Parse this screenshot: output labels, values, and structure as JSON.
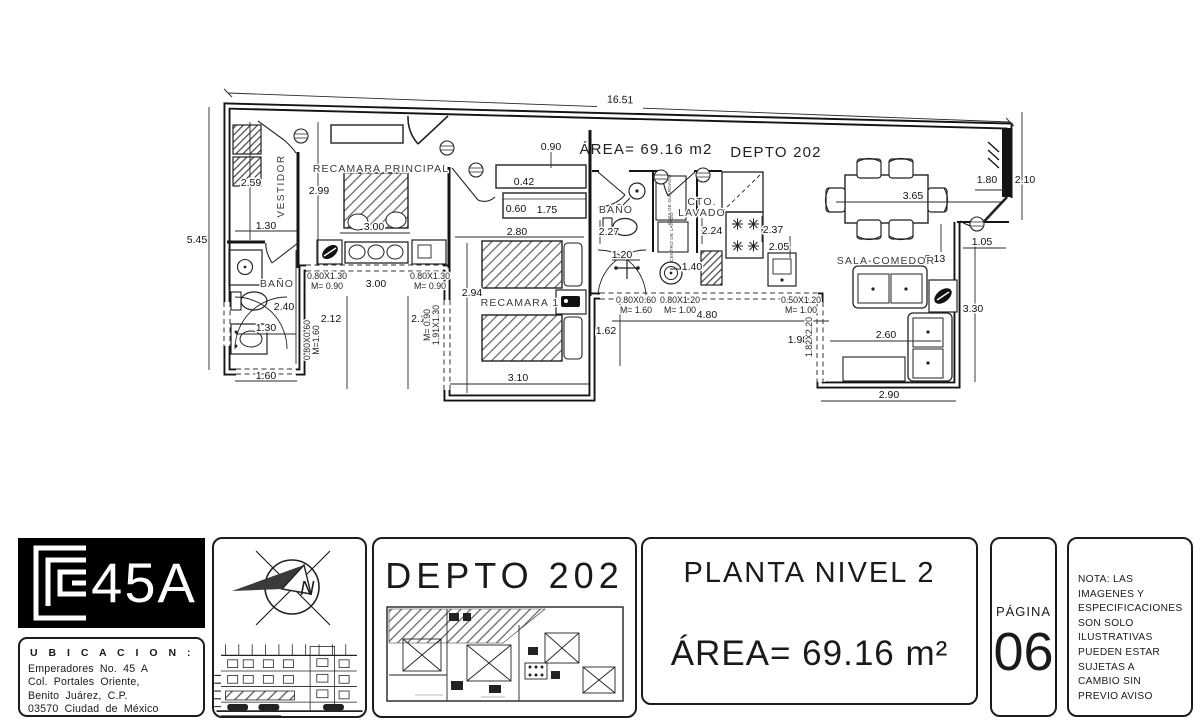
{
  "plan": {
    "area_text": "ÁREA= 69.16 m2",
    "unit_text": "DEPTO 202",
    "rooms": {
      "vestidor": "VESTIDOR",
      "recamara_principal": "RECAMARA PRINCIPAL",
      "banio_1": "BAÑO",
      "recamara_1": "RECAMARA 1",
      "banio_2": "BAÑO",
      "cto_lavado_l1": "CTO.",
      "cto_lavado_l2": "LAVADO",
      "area_guardado": "ÁREA DE GUARDADO",
      "centro_lavado": "CENTRO DE LAVADO",
      "sala_comedor": "SALA-COMEDOR"
    },
    "dims": {
      "d1651": "16.51",
      "d545": "5.45",
      "d259": "2.59",
      "d299": "2.99",
      "d130a": "1.30",
      "d300a": "3.00",
      "d300b": "3.00",
      "d090": "0.90",
      "d042": "0.42",
      "d060": "0.60",
      "d175": "1.75",
      "d280": "2.80",
      "d227": "2.27",
      "d120": "1.20",
      "d224": "2.24",
      "d237": "2.37",
      "d205": "2.05",
      "d365": "3.65",
      "d180": "1.80",
      "d210": "2.10",
      "d105": "1.05",
      "d513": "5.13",
      "d330": "3.30",
      "d240": "2.40",
      "d130b": "1.30",
      "d160": "1.60",
      "d212": "2.12",
      "d211": "2.11",
      "d294": "2.94",
      "d310": "3.10",
      "d162": "1.62",
      "d480": "4.80",
      "d140": "1.40",
      "d198": "1.98",
      "d260": "2.60",
      "d290": "2.90"
    },
    "openings": {
      "w1_l1": "0.80X1.30",
      "w1_l2": "M= 0.90",
      "w2_l1": "0.80X1.30",
      "w2_l2": "M= 0.90",
      "w3_l1": "0.80X0.60",
      "w3_l2": "M= 1.60",
      "w4_l1": "0.80X1.20",
      "w4_l2": "M= 1.00",
      "w5_l1": "0.50X1.20",
      "w5_l2": "M= 1.00",
      "w6_l1": "0.80X0.60",
      "w6_l2": "M=1.60",
      "w7_l1": "M= 0.90",
      "w7_l2": "1.91X1.30",
      "w8": "1.82X2.20"
    }
  },
  "titleblock": {
    "logo_text": "45A",
    "ubicacion_title": "U B I C A C I O N :",
    "ubicacion_lines": [
      "Emperadores No. 45 A",
      "Col. Portales Oriente,",
      "Benito Juárez, C.P.",
      "03570 Ciudad de México"
    ],
    "compass_n": "N",
    "depto_title": "DEPTO 202",
    "planta_title": "PLANTA NIVEL 2",
    "area_title": "ÁREA= 69.16 m²",
    "pagina_label": "PÁGINA",
    "pagina_number": "06",
    "nota_lines": [
      "NOTA: LAS",
      "IMAGENES Y",
      "ESPECIFICACIONES",
      "SON SOLO",
      "ILUSTRATIVAS",
      "PUEDEN ESTAR",
      "SUJETAS A",
      "CAMBIO SIN",
      "PREVIO AVISO"
    ]
  }
}
